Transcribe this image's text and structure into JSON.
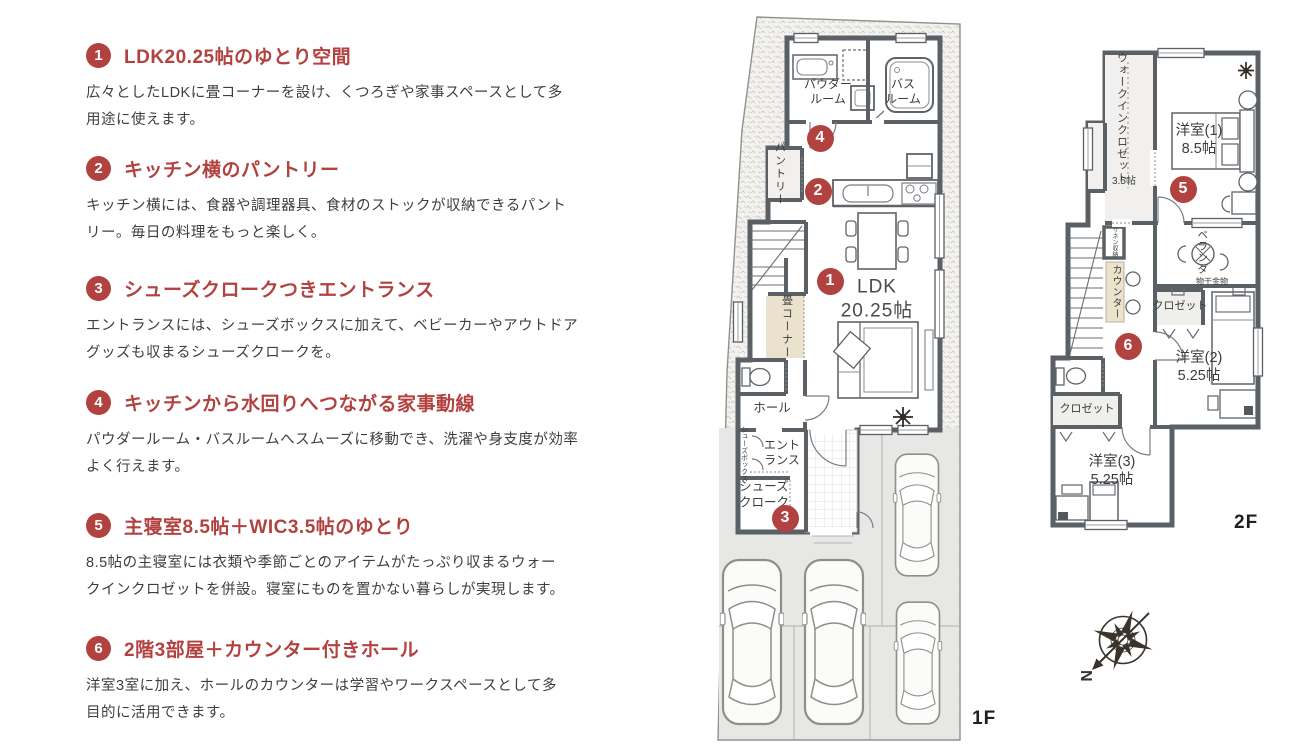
{
  "accent_color": "#b2423f",
  "features": [
    {
      "number": "1",
      "title": "LDK20.25帖のゆとり空間",
      "description": "広々としたLDKに畳コーナーを設け、くつろぎや家事スペースとして多\n用途に使えます。"
    },
    {
      "number": "2",
      "title": "キッチン横のパントリー",
      "description": "キッチン横には、食器や調理器具、食材のストックが収納できるパント\nリー。毎日の料理をもっと楽しく。"
    },
    {
      "number": "3",
      "title": "シューズクロークつきエントランス",
      "description": "エントランスには、シューズボックスに加えて、ベビーカーやアウトドア\nグッズも収まるシューズクロークを。"
    },
    {
      "number": "4",
      "title": "キッチンから水回りへつながる家事動線",
      "description": "パウダールーム・バスルームへスムーズに移動でき、洗濯や身支度が効率\nよく行えます。"
    },
    {
      "number": "5",
      "title": "主寝室8.5帖＋WIC3.5帖のゆとり",
      "description": "8.5帖の主寝室には衣類や季節ごとのアイテムがたっぷり収まるウォー\nクインクロゼットを併設。寝室にものを置かない暮らしが実現します。"
    },
    {
      "number": "6",
      "title": "2階3部屋＋カウンター付きホール",
      "description": "洋室3室に加え、ホールのカウンターは学習やワークスペースとして多\n目的に活用できます。"
    }
  ],
  "floor1": {
    "label": "1F",
    "rooms": {
      "powder": "パウダー\nルーム",
      "bath": "バス\nルーム",
      "pantry": "パントリー",
      "ldk": "LDK\n20.25帖",
      "tatami": "畳コーナー",
      "hall": "ホール",
      "entrance": "エント\nランス",
      "shoes_box": "シューズボックス",
      "shoes_cloak": "シューズ\nクローク"
    },
    "markers": [
      {
        "no": "1"
      },
      {
        "no": "2"
      },
      {
        "no": "3"
      },
      {
        "no": "4"
      }
    ]
  },
  "floor2": {
    "label": "2F",
    "rooms": {
      "wic": "ウォークインクロゼット",
      "wic_size": "3.5帖",
      "room1": "洋室(1)\n8.5帖",
      "veranda": "ベランダ",
      "monohoshi": "物干金物",
      "closet1": "クロゼット",
      "room2": "洋室(2)\n5.25帖",
      "closet2": "クロゼット",
      "room3": "洋室(3)\n5.25帖",
      "counter": "カウンター",
      "linen": "リネン収納"
    },
    "markers": [
      {
        "no": "5"
      },
      {
        "no": "6"
      }
    ]
  },
  "compass": {
    "north_label": "N"
  }
}
